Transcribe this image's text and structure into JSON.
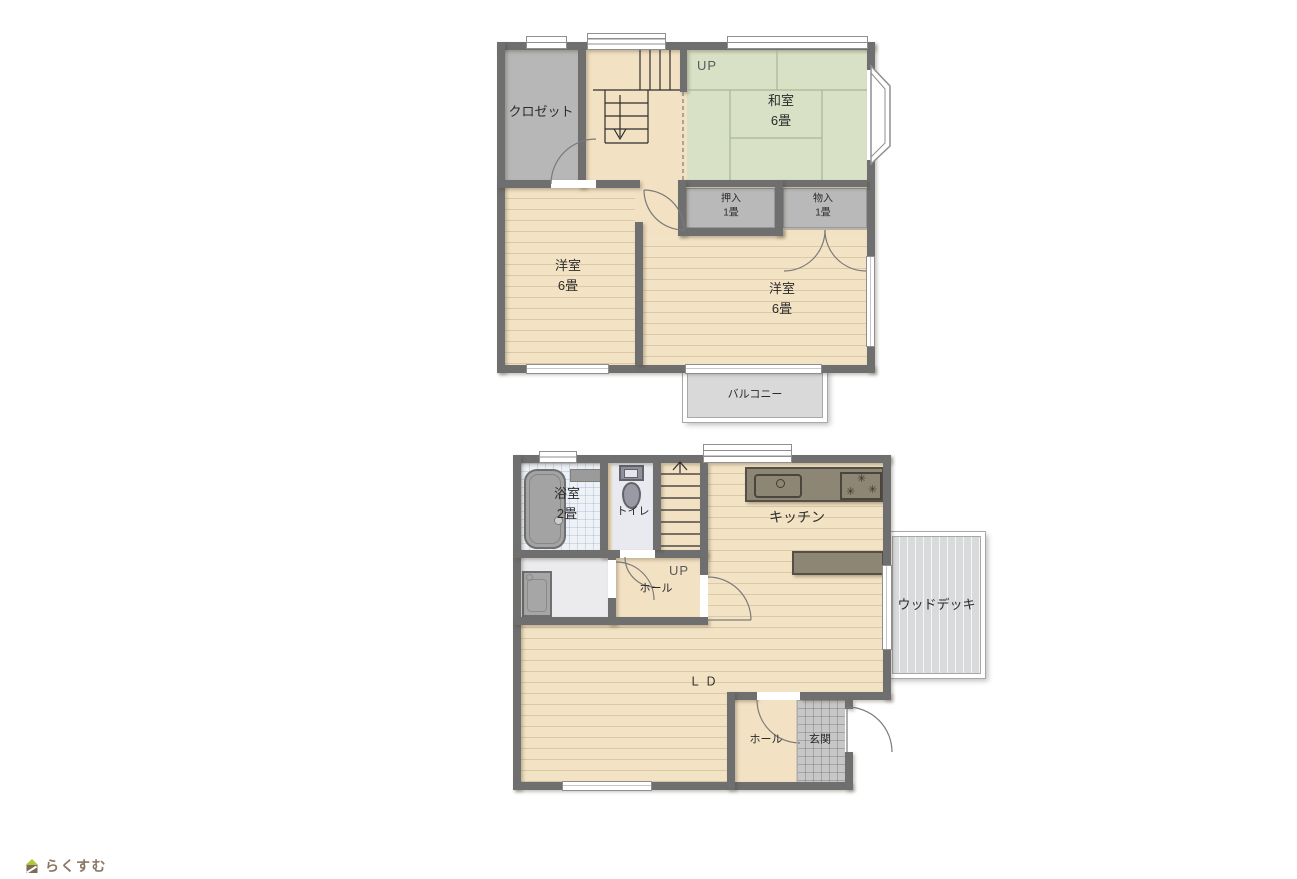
{
  "logo": {
    "text": "らくすむ",
    "icon": "house-logo-icon"
  },
  "floor2": {
    "rooms": {
      "closet": {
        "label": "クロゼット"
      },
      "stairs": {
        "label": "UP"
      },
      "washitsu": {
        "label": "和室",
        "size": "6畳"
      },
      "oshiire": {
        "label": "押入",
        "size": "1畳"
      },
      "monoire": {
        "label": "物入",
        "size": "1畳"
      },
      "yoshitsu_left": {
        "label": "洋室",
        "size": "6畳"
      },
      "yoshitsu_right": {
        "label": "洋室",
        "size": "6畳"
      },
      "balcony": {
        "label": "バルコニー"
      }
    }
  },
  "floor1": {
    "rooms": {
      "bathroom": {
        "label": "浴室",
        "size": "2畳"
      },
      "toilet": {
        "label": "トイレ"
      },
      "stairs": {
        "label": "UP"
      },
      "hall_center": {
        "label": "ホール"
      },
      "kitchen": {
        "label": "キッチン"
      },
      "living_dining": {
        "label": "ＬＤ"
      },
      "hall_entrance": {
        "label": "ホール"
      },
      "entrance": {
        "label": "玄関"
      },
      "wood_deck": {
        "label": "ウッドデッキ"
      }
    }
  },
  "colors": {
    "wall": "#6f6f6f",
    "wood_floor": "#f2e1c2",
    "tatami": "#d8e0c6",
    "storage_gray": "#b7b7b7",
    "balcony_gray": "#d9d9d9",
    "wood_deck_gray": "#d8dadc",
    "bath_tile": "#eef2f7",
    "entrance_tile": "#c7c7c7",
    "kitchen_counter": "#8e8675",
    "logo_text": "#8b7763",
    "logo_roof": "#b2c832",
    "logo_body": "#7d6c57"
  }
}
